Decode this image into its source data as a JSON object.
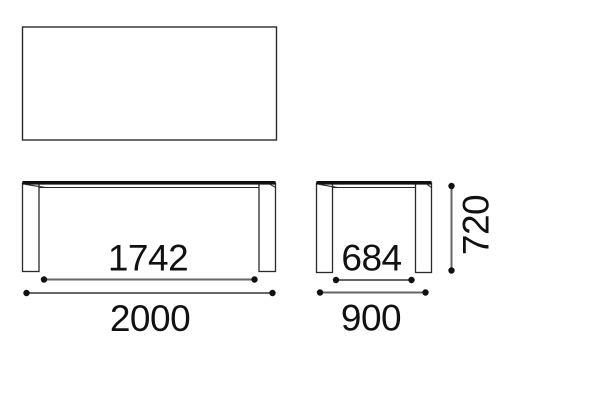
{
  "drawing": {
    "dimensions": {
      "front_inner": "1742",
      "front_overall": "2000",
      "side_inner": "684",
      "side_overall": "900",
      "height": "720"
    },
    "colors": {
      "outline": "#2a2a2a",
      "surface_band": "#111111",
      "dimension_line": "#666666",
      "dot": "#111111",
      "text": "#111111",
      "background": "#ffffff"
    }
  }
}
